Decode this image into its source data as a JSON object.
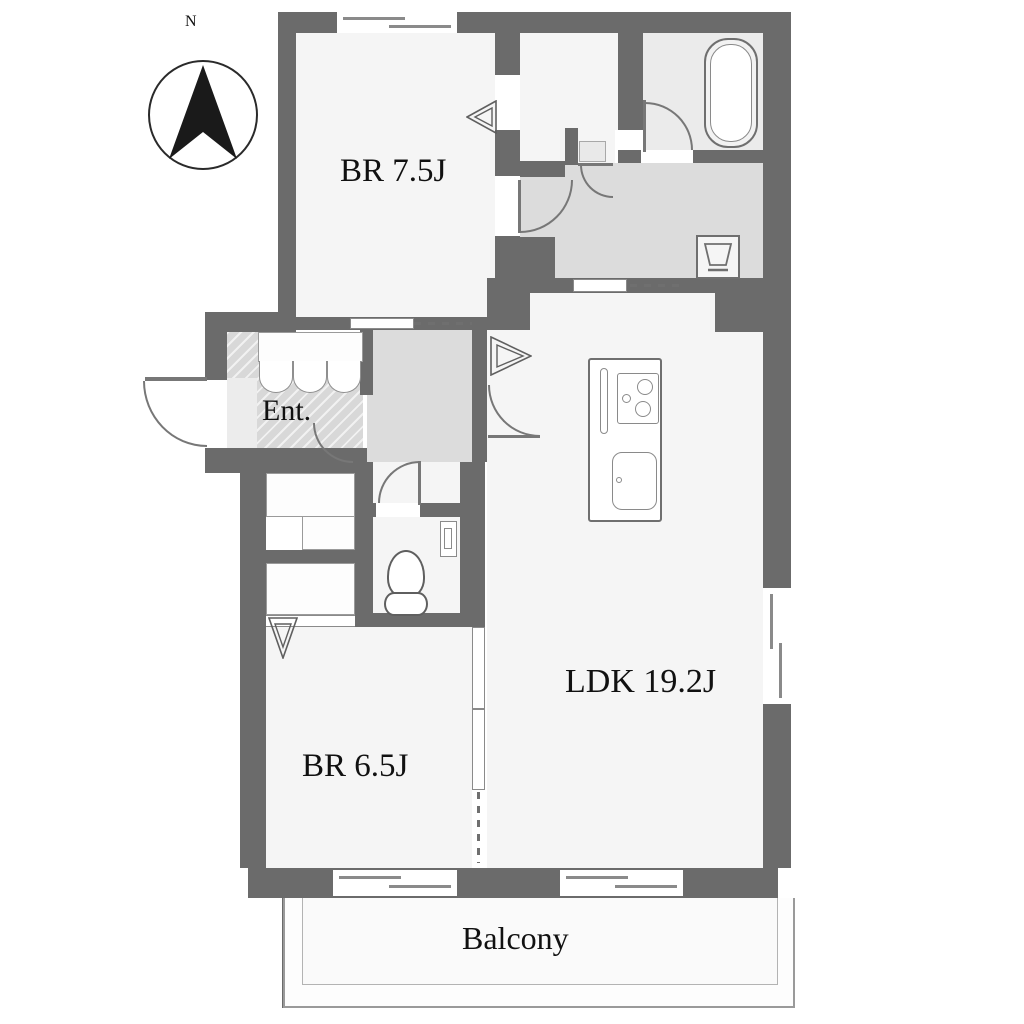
{
  "compass": {
    "label": "N"
  },
  "rooms": {
    "br75": {
      "label": "BR 7.5J"
    },
    "ent": {
      "label": "Ent."
    },
    "ldk": {
      "label": "LDK 19.2J"
    },
    "br65": {
      "label": "BR 6.5J"
    },
    "balcony": {
      "label": "Balcony"
    }
  },
  "fixtures": [
    "bathtub",
    "washbasin",
    "washing-machine-pan",
    "toilet",
    "toilet-shelf",
    "kitchen-island",
    "stove",
    "sink",
    "shoe-cabinet",
    "closet-folding-doors",
    "sliding-doors",
    "windows",
    "compass-north-arrow"
  ],
  "colors": {
    "wall": "#6b6b6b",
    "line": "#777777",
    "room": "#f5f5f5",
    "service": "#dcdcdc",
    "bath": "#ebebeb",
    "text": "#111111"
  }
}
